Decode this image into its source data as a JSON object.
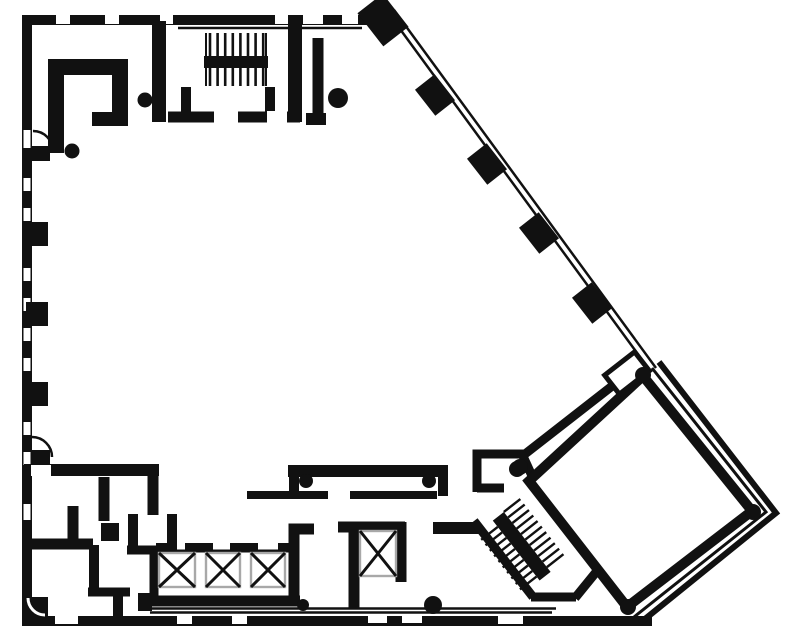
{
  "meta": {
    "kind": "architectural-floor-plan",
    "canvas": {
      "w": 787,
      "h": 641
    }
  },
  "colors": {
    "ink": "#111111",
    "paper": "#ffffff",
    "gray": "#a8a8a8"
  },
  "plan": {
    "layers": [
      {
        "kind": "path",
        "n": "top-exterior-wall",
        "d": "M22 20 H391",
        "w": 10
      },
      {
        "kind": "path",
        "n": "left-exterior-wall",
        "d": "M27 15 V621",
        "w": 10
      },
      {
        "kind": "path",
        "n": "bottom-exterior-wall",
        "d": "M22 621 H652",
        "w": 10
      },
      {
        "kind": "path",
        "n": "lobby-thin-line",
        "d": "M150 608.5 H556",
        "w": 2.4
      },
      {
        "kind": "path",
        "n": "lobby-thin-line",
        "d": "M150 612.5 H552",
        "w": 2.4
      },
      {
        "kind": "path",
        "n": "curtain-wall-glass-line",
        "d": "M389 14 L651 372",
        "w": 2.5
      },
      {
        "kind": "path",
        "n": "curtain-wall-glass-line",
        "d": "M394 10 L656 368",
        "w": 2.5
      },
      {
        "kind": "path",
        "n": "top-interior-thin-line",
        "d": "M178 28 H362",
        "w": 2.5
      },
      {
        "kind": "rect",
        "n": "window-gap",
        "x": 56,
        "y": 15,
        "w": 14,
        "h": 9,
        "f": "paper"
      },
      {
        "kind": "rect",
        "n": "window-gap",
        "x": 105,
        "y": 15,
        "w": 14,
        "h": 9,
        "f": "paper"
      },
      {
        "kind": "rect",
        "n": "window-gap",
        "x": 160,
        "y": 15,
        "w": 13,
        "h": 9,
        "f": "paper"
      },
      {
        "kind": "rect",
        "n": "window-gap",
        "x": 275,
        "y": 15,
        "w": 13,
        "h": 9,
        "f": "paper"
      },
      {
        "kind": "rect",
        "n": "window-gap",
        "x": 303,
        "y": 15,
        "w": 8,
        "h": 9,
        "f": "paper"
      },
      {
        "kind": "rect",
        "n": "window-gap",
        "x": 311,
        "y": 15,
        "w": 12,
        "h": 9,
        "f": "paper"
      },
      {
        "kind": "rect",
        "n": "window-gap",
        "x": 342,
        "y": 15,
        "w": 16,
        "h": 9,
        "f": "paper"
      },
      {
        "kind": "rect",
        "n": "window-gap",
        "x": 23.5,
        "y": 130,
        "w": 7,
        "h": 18,
        "f": "paper"
      },
      {
        "kind": "rect",
        "n": "window-gap",
        "x": 23.5,
        "y": 178,
        "w": 7,
        "h": 13,
        "f": "paper"
      },
      {
        "kind": "rect",
        "n": "window-gap",
        "x": 23.5,
        "y": 208,
        "w": 7,
        "h": 13,
        "f": "paper"
      },
      {
        "kind": "rect",
        "n": "window-gap",
        "x": 23.5,
        "y": 268,
        "w": 7,
        "h": 13,
        "f": "paper"
      },
      {
        "kind": "rect",
        "n": "window-gap",
        "x": 23.5,
        "y": 298,
        "w": 7,
        "h": 13,
        "f": "paper"
      },
      {
        "kind": "rect",
        "n": "window-gap",
        "x": 23.5,
        "y": 328,
        "w": 7,
        "h": 13,
        "f": "paper"
      },
      {
        "kind": "rect",
        "n": "window-gap",
        "x": 23.5,
        "y": 358,
        "w": 7,
        "h": 13,
        "f": "paper"
      },
      {
        "kind": "rect",
        "n": "window-gap",
        "x": 23.5,
        "y": 422,
        "w": 7,
        "h": 13,
        "f": "paper"
      },
      {
        "kind": "rect",
        "n": "window-gap",
        "x": 23.5,
        "y": 452,
        "w": 7,
        "h": 13,
        "f": "paper"
      },
      {
        "kind": "rect",
        "n": "window-gap",
        "x": 23.5,
        "y": 504,
        "w": 7,
        "h": 16,
        "f": "paper"
      },
      {
        "kind": "rect",
        "n": "window-gap",
        "x": 55,
        "y": 615,
        "w": 23,
        "h": 9,
        "f": "paper"
      },
      {
        "kind": "rect",
        "n": "window-gap",
        "x": 177,
        "y": 615,
        "w": 15,
        "h": 9,
        "f": "paper"
      },
      {
        "kind": "rect",
        "n": "window-gap",
        "x": 232,
        "y": 615,
        "w": 15,
        "h": 9,
        "f": "paper"
      },
      {
        "kind": "rect",
        "n": "window-gap",
        "x": 368,
        "y": 615,
        "w": 19,
        "h": 8,
        "f": "paper"
      },
      {
        "kind": "rect",
        "n": "window-gap",
        "x": 402,
        "y": 615,
        "w": 20,
        "h": 8,
        "f": "paper"
      },
      {
        "kind": "rect",
        "n": "window-gap",
        "x": 498,
        "y": 615,
        "w": 25,
        "h": 9,
        "f": "paper"
      },
      {
        "kind": "rect",
        "n": "left-wall-column",
        "x": 26,
        "y": 222,
        "w": 22,
        "h": 24
      },
      {
        "kind": "rect",
        "n": "left-wall-column",
        "x": 26,
        "y": 302,
        "w": 22,
        "h": 24
      },
      {
        "kind": "rect",
        "n": "left-wall-column",
        "x": 26,
        "y": 382,
        "w": 22,
        "h": 24
      },
      {
        "kind": "rect",
        "n": "door-leaf",
        "x": 32,
        "y": 146,
        "w": 18,
        "h": 15
      },
      {
        "kind": "path",
        "n": "door-swing-arc",
        "d": "M33 131 A20 20 0 0 1 53 151",
        "w": 2.5
      },
      {
        "kind": "rect",
        "n": "door-leaf",
        "x": 31,
        "y": 450,
        "w": 19,
        "h": 14
      },
      {
        "kind": "path",
        "n": "door-swing-arc",
        "d": "M32 437 A20 20 0 0 1 52 457",
        "w": 2.5
      },
      {
        "kind": "rect",
        "n": "corner-fillet-block",
        "x": 24,
        "y": 597,
        "w": 24,
        "h": 22
      },
      {
        "kind": "path",
        "n": "corner-fillet-arc",
        "d": "M28 598 A17 17 0 0 0 45 615",
        "w": 3,
        "c": "paper"
      },
      {
        "kind": "path",
        "n": "upper-left-room-partition",
        "d": "M56 153 V67 H120 V112",
        "w": 16
      },
      {
        "kind": "path",
        "n": "upper-left-room-partition-foot",
        "d": "M92 119 H128",
        "w": 14
      },
      {
        "kind": "circle",
        "n": "door-pivot-dot",
        "cx": 145,
        "cy": 100,
        "r": 7.5
      },
      {
        "kind": "circle",
        "n": "door-pivot-dot",
        "cx": 72,
        "cy": 151,
        "r": 7.5
      },
      {
        "kind": "path",
        "n": "stairwell-left-wall",
        "d": "M159 21 V122",
        "w": 14
      },
      {
        "kind": "path",
        "n": "stairwell-right-wall",
        "d": "M295 20 V122",
        "w": 14
      },
      {
        "kind": "path",
        "n": "stairwell-bottom-wall",
        "d": "M168 117 H300",
        "w": 11
      },
      {
        "kind": "path",
        "n": "stairwell-inner-wall",
        "d": "M186 87 V112",
        "w": 10
      },
      {
        "kind": "path",
        "n": "stairwell-inner-wall",
        "d": "M270 87 V112",
        "w": 10
      },
      {
        "kind": "rect",
        "n": "door-gap",
        "x": 214,
        "y": 111,
        "w": 24,
        "h": 12,
        "f": "paper"
      },
      {
        "kind": "rect",
        "n": "door-gap",
        "x": 267,
        "y": 111,
        "w": 20,
        "h": 12,
        "f": "paper"
      },
      {
        "kind": "path",
        "n": "stair-rail",
        "d": "M206 33 V86",
        "w": 2
      },
      {
        "kind": "path",
        "n": "stair-rail",
        "d": "M266 33 V86",
        "w": 2
      },
      {
        "kind": "hatch",
        "n": "stair-treads-upper-flight",
        "x": 210,
        "y": 33,
        "n2": 8,
        "step": 7.6,
        "len": 23,
        "dir": "v",
        "w": 2.6
      },
      {
        "kind": "hatch",
        "n": "stair-treads-lower-flight",
        "x": 210,
        "y": 68,
        "n2": 8,
        "step": 7.6,
        "len": 18,
        "dir": "v",
        "w": 2.6
      },
      {
        "kind": "rect",
        "n": "stair-landing-bar",
        "x": 204,
        "y": 56,
        "w": 64,
        "h": 12
      },
      {
        "kind": "path",
        "n": "room-partition-wall",
        "d": "M318 38 V118",
        "w": 11
      },
      {
        "kind": "path",
        "n": "room-partition-foot",
        "d": "M306 119 H326",
        "w": 12
      },
      {
        "kind": "circle",
        "n": "door-pivot-dot",
        "cx": 338,
        "cy": 98,
        "r": 10
      },
      {
        "kind": "rect",
        "n": "facade-corner-column",
        "x": 362,
        "y": 4,
        "w": 42,
        "h": 32,
        "rot": 52
      },
      {
        "kind": "rect",
        "n": "facade-column",
        "x": 418.5,
        "y": 82.5,
        "w": 33,
        "h": 25,
        "rot": 52
      },
      {
        "kind": "rect",
        "n": "facade-column",
        "x": 470.5,
        "y": 151.5,
        "w": 33,
        "h": 25,
        "rot": 52
      },
      {
        "kind": "rect",
        "n": "facade-column",
        "x": 522.5,
        "y": 220.5,
        "w": 33,
        "h": 25,
        "rot": 52
      },
      {
        "kind": "rect",
        "n": "facade-column",
        "x": 575.5,
        "y": 290.5,
        "w": 33,
        "h": 25,
        "rot": 52
      },
      {
        "kind": "path",
        "n": "diagonal-partition-wall",
        "d": "M525 454 L634 369",
        "w": 9
      },
      {
        "kind": "path",
        "n": "vestibule-room-walls",
        "d": "M477 492 V454 H522 L538 489",
        "w": 9
      },
      {
        "kind": "path",
        "n": "vestibule-room-bottom",
        "d": "M477 488 H504",
        "w": 9
      },
      {
        "kind": "circle",
        "n": "door-pivot-dot",
        "cx": 517,
        "cy": 469,
        "r": 8
      },
      {
        "kind": "path",
        "n": "stair2-jog-wall",
        "d": "M433 528 H480",
        "w": 12
      },
      {
        "kind": "path",
        "n": "stair2-left-wall",
        "d": "M474 521 L533 597",
        "w": 9
      },
      {
        "kind": "path",
        "n": "stair2-bottom-wall",
        "d": "M531 597 H576",
        "w": 9
      },
      {
        "kind": "path",
        "n": "stair2-end-wall",
        "d": "M575 598 L597 571",
        "w": 9
      },
      {
        "kind": "group",
        "n": "diagonal-staircase",
        "tx": 502,
        "ty": 521,
        "rot": 52,
        "items": [
          {
            "kind": "hatch",
            "n": "stair-treads-flight-a",
            "x": -6,
            "y": -28,
            "n2": 11,
            "step": 7,
            "len": 21,
            "dir": "v",
            "w": 2.4
          },
          {
            "kind": "hatch",
            "n": "stair-treads-flight-b",
            "x": 2,
            "y": 7,
            "n2": 10,
            "step": 7,
            "len": 21,
            "dir": "v",
            "w": 2.4
          },
          {
            "kind": "rect",
            "n": "stair-landing-bar",
            "x": -6,
            "y": -7,
            "w": 76,
            "h": 14
          }
        ]
      },
      {
        "kind": "poly",
        "n": "rotated-square-room",
        "pts": [
          [
            643,
            376
          ],
          [
            752,
            511
          ],
          [
            627,
            607
          ],
          [
            529,
            481
          ]
        ],
        "f": "paper",
        "s": "ink",
        "sw": 10
      },
      {
        "kind": "poly",
        "n": "exterior-double-wall-inner",
        "pts": [
          [
            652,
            368
          ],
          [
            766,
            512
          ],
          [
            634,
            617
          ]
        ],
        "s": "ink",
        "sw": 3,
        "open": true
      },
      {
        "kind": "poly",
        "n": "exterior-double-wall-outer",
        "pts": [
          [
            659,
            362
          ],
          [
            776,
            513
          ],
          [
            640,
            623
          ]
        ],
        "s": "ink",
        "sw": 6,
        "open": true
      },
      {
        "kind": "group",
        "n": "square-room-corner-tab",
        "tx": 627,
        "ty": 373,
        "rot": -38,
        "items": [
          {
            "kind": "rect",
            "n": "corner-tab-rect",
            "x": -19,
            "y": -12,
            "w": 38,
            "h": 24,
            "f": "paper",
            "s": "ink",
            "sw": 5
          }
        ]
      },
      {
        "kind": "circle",
        "n": "column-dot",
        "cx": 643,
        "cy": 375,
        "r": 8
      },
      {
        "kind": "circle",
        "n": "column-dot",
        "cx": 753,
        "cy": 512,
        "r": 8
      },
      {
        "kind": "circle",
        "n": "column-dot",
        "cx": 628,
        "cy": 607,
        "r": 8
      },
      {
        "kind": "circle",
        "n": "column-dot",
        "cx": 520,
        "cy": 467,
        "r": 8
      },
      {
        "kind": "path",
        "n": "corridor-wall-end-cap",
        "d": "M294 466 V496",
        "w": 10
      },
      {
        "kind": "path",
        "n": "corridor-upper-wall",
        "d": "M288 471 H448",
        "w": 12
      },
      {
        "kind": "path",
        "n": "corridor-wall-end-cap",
        "d": "M443 466 V496",
        "w": 10
      },
      {
        "kind": "circle",
        "n": "door-pivot-dot",
        "cx": 306,
        "cy": 481,
        "r": 7
      },
      {
        "kind": "circle",
        "n": "door-pivot-dot",
        "cx": 429,
        "cy": 481,
        "r": 7
      },
      {
        "kind": "path",
        "n": "corridor-lower-wall",
        "d": "M247 495 H328",
        "w": 8
      },
      {
        "kind": "path",
        "n": "corridor-lower-wall",
        "d": "M350 495 H437",
        "w": 8
      },
      {
        "kind": "path",
        "n": "southwest-room-wall",
        "d": "M24 470 H159",
        "w": 12
      },
      {
        "kind": "rect",
        "n": "cased-opening",
        "x": 31,
        "y": 465,
        "w": 20,
        "h": 11,
        "f": "paper"
      },
      {
        "kind": "path",
        "n": "southwest-room-wall",
        "d": "M153 470 V515",
        "w": 11
      },
      {
        "kind": "path",
        "n": "southwest-room-wall",
        "d": "M73 506 V545",
        "w": 11
      },
      {
        "kind": "path",
        "n": "southwest-room-wall",
        "d": "M28 544 H93",
        "w": 11
      },
      {
        "kind": "path",
        "n": "southwest-room-wall",
        "d": "M104 477 V521",
        "w": 11
      },
      {
        "kind": "rect",
        "n": "wall-block",
        "x": 101,
        "y": 523,
        "w": 18,
        "h": 18
      },
      {
        "kind": "path",
        "n": "closet-wall",
        "d": "M133 514 V552",
        "w": 10
      },
      {
        "kind": "path",
        "n": "closet-wall",
        "d": "M127 550 H177",
        "w": 9
      },
      {
        "kind": "path",
        "n": "closet-wall",
        "d": "M172 514 V550",
        "w": 10
      },
      {
        "kind": "path",
        "n": "restroom-wall",
        "d": "M94 545 V593",
        "w": 10
      },
      {
        "kind": "path",
        "n": "restroom-wall",
        "d": "M88 592 H130",
        "w": 9
      },
      {
        "kind": "path",
        "n": "restroom-wall",
        "d": "M118 594 V620",
        "w": 10
      },
      {
        "kind": "path",
        "n": "elevator-bank-top-line",
        "d": "M156 551 H296",
        "w": 3
      },
      {
        "kind": "rect",
        "n": "elevator-door-jamb",
        "x": 156,
        "y": 543,
        "w": 12,
        "h": 9
      },
      {
        "kind": "rect",
        "n": "elevator-door-jamb",
        "x": 185,
        "y": 543,
        "w": 28,
        "h": 9
      },
      {
        "kind": "rect",
        "n": "elevator-door-jamb",
        "x": 230,
        "y": 543,
        "w": 28,
        "h": 9
      },
      {
        "kind": "rect",
        "n": "elevator-door-jamb",
        "x": 278,
        "y": 543,
        "w": 13,
        "h": 9
      },
      {
        "kind": "path",
        "n": "elevator-bank-left-wall",
        "d": "M154 552 V601",
        "w": 9
      },
      {
        "kind": "path",
        "n": "elevator-bank-right-wall",
        "d": "M314 529 H294 V601",
        "w": 11
      },
      {
        "kind": "path",
        "n": "elevator-bank-bottom-wall",
        "d": "M150 601 H300",
        "w": 11
      },
      {
        "kind": "rect",
        "n": "wall-block",
        "x": 138,
        "y": 593,
        "w": 14,
        "h": 18
      },
      {
        "kind": "circle",
        "n": "door-pivot-dot",
        "cx": 303,
        "cy": 605,
        "r": 6
      },
      {
        "kind": "xbox",
        "n": "elevator-shaft",
        "x": 159,
        "y": 553,
        "w": 36,
        "h": 34
      },
      {
        "kind": "xbox",
        "n": "elevator-shaft",
        "x": 206,
        "y": 553,
        "w": 34,
        "h": 34
      },
      {
        "kind": "xbox",
        "n": "elevator-shaft",
        "x": 251,
        "y": 553,
        "w": 34,
        "h": 34
      },
      {
        "kind": "path",
        "n": "service-elevator-top-wall",
        "d": "M338 527 H405",
        "w": 11
      },
      {
        "kind": "path",
        "n": "service-elevator-left-wall",
        "d": "M354 522 V608",
        "w": 11
      },
      {
        "kind": "path",
        "n": "service-elevator-right-wall",
        "d": "M401 522 V582",
        "w": 11
      },
      {
        "kind": "xbox",
        "n": "service-elevator-shaft",
        "x": 360,
        "y": 531,
        "w": 36,
        "h": 45
      },
      {
        "kind": "circle",
        "n": "door-pivot-dot",
        "cx": 433,
        "cy": 605,
        "r": 9
      }
    ]
  }
}
